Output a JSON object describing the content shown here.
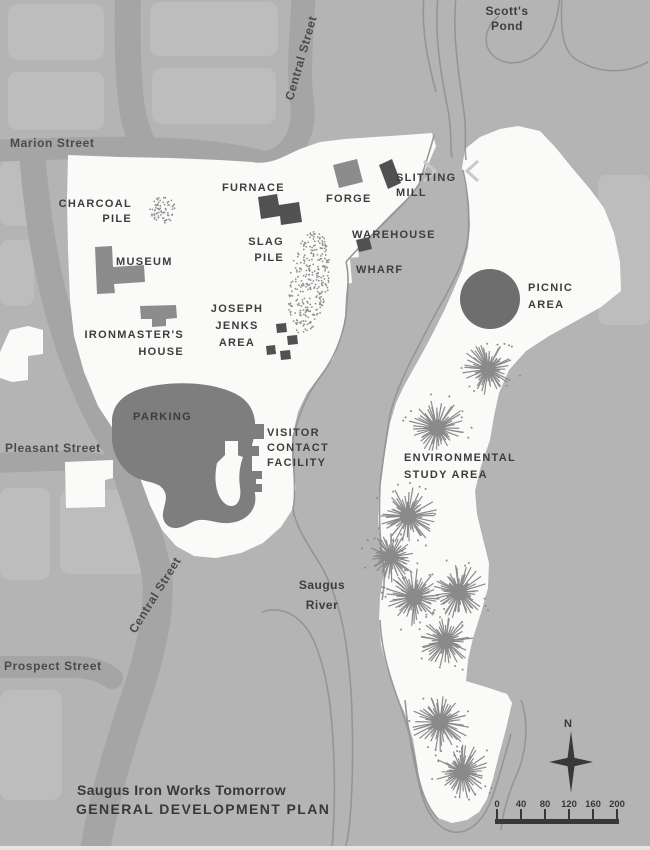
{
  "map": {
    "title_line1": "Saugus Iron Works Tomorrow",
    "title_line2": "GENERAL DEVELOPMENT PLAN",
    "compass_north": "N",
    "scale_ticks": [
      "0",
      "40",
      "80",
      "120",
      "160",
      "200"
    ],
    "streets": {
      "marion": "Marion Street",
      "central_top": "Central Street",
      "central_bottom": "Central Street",
      "pleasant": "Pleasant Street",
      "prospect": "Prospect Street"
    },
    "water": {
      "scotts_pond": [
        "Scott's",
        "Pond"
      ],
      "saugus_river": [
        "Saugus",
        "River"
      ]
    },
    "features": {
      "charcoal_pile": [
        "CHARCOAL",
        "PILE"
      ],
      "furnace": "FURNACE",
      "forge": "FORGE",
      "slitting_mill": [
        "SLITTING",
        "MILL"
      ],
      "warehouse": "WAREHOUSE",
      "wharf": "WHARF",
      "slag_pile": [
        "SLAG",
        "PILE"
      ],
      "museum": "MUSEUM",
      "joseph_jenks_area": [
        "JOSEPH",
        "JENKS",
        "AREA"
      ],
      "ironmasters_house": [
        "IRONMASTER'S",
        "HOUSE"
      ],
      "picnic_area": [
        "PICNIC",
        "AREA"
      ],
      "parking": "PARKING",
      "visitor_contact_facility": [
        "VISITOR",
        "CONTACT",
        "FACILITY"
      ],
      "environmental_study_area": [
        "ENVIRONMENTAL",
        "STUDY AREA"
      ]
    },
    "trees": [
      {
        "x": 488,
        "y": 369,
        "r": 26
      },
      {
        "x": 437,
        "y": 428,
        "r": 28
      },
      {
        "x": 408,
        "y": 516,
        "r": 28
      },
      {
        "x": 391,
        "y": 557,
        "r": 25
      },
      {
        "x": 414,
        "y": 597,
        "r": 28
      },
      {
        "x": 459,
        "y": 592,
        "r": 27
      },
      {
        "x": 446,
        "y": 641,
        "r": 26
      },
      {
        "x": 440,
        "y": 722,
        "r": 29
      },
      {
        "x": 462,
        "y": 772,
        "r": 27
      }
    ],
    "colors": {
      "bg": "#b4b4b4",
      "block": "#bdbdbd",
      "road": "#a5a5a5",
      "site": "#fafaf8",
      "bdark": "#515151",
      "bmed": "#8c8c8c",
      "parking": "#7e7e7e",
      "picnic": "#6e6e6e",
      "tree": "#8a8a8a",
      "rline": "#949494",
      "text": "#3d3d3d",
      "streettext": "#4a4a4a",
      "titletext": "#383838",
      "chevron": "#c9c9c9",
      "stipple": "#8f8f8f"
    }
  }
}
